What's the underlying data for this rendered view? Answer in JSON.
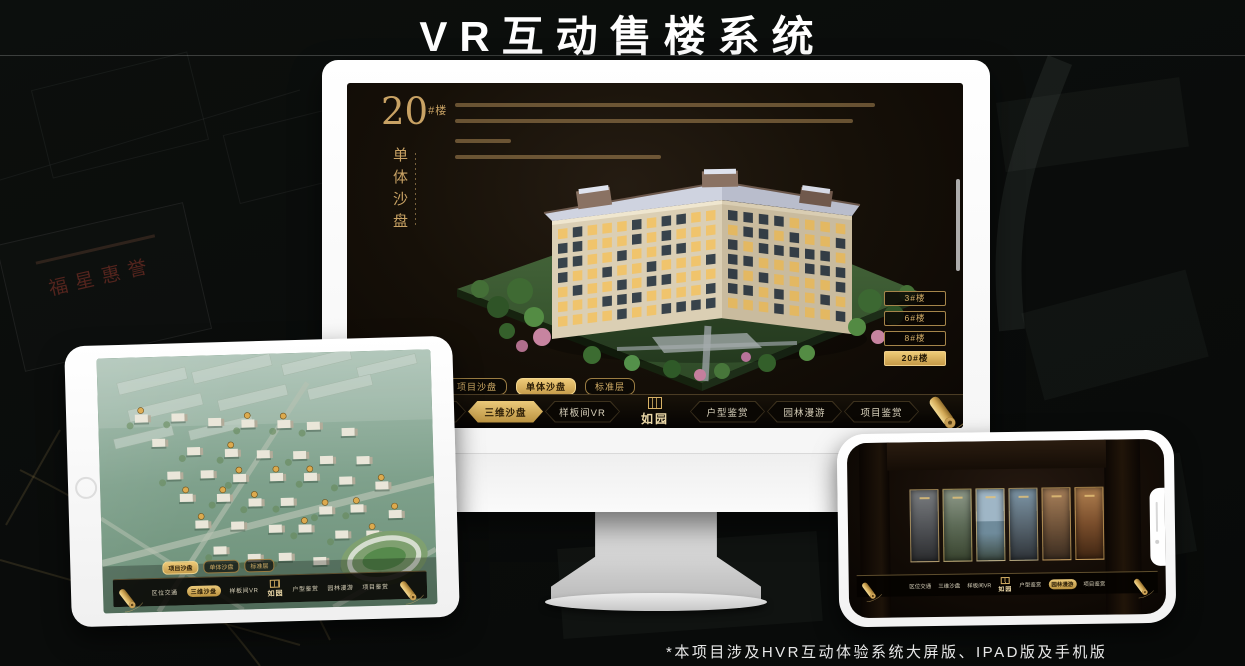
{
  "page": {
    "title": "VR互动售楼系统",
    "footnote": "*本项目涉及HVR互动体验系统大屏版、IPAD版及手机版"
  },
  "background": {
    "plaque_text": "福星惠誉"
  },
  "colors": {
    "gold": "#c79e58",
    "gold_bright": "#ecca7e",
    "active_text": "#2a1c06",
    "screen_bg": "#140e08",
    "device_frame": "#ffffff"
  },
  "monitor": {
    "headline": {
      "number": "20",
      "suffix": "#楼",
      "subtitle": "单体沙盘"
    },
    "floor_buttons": [
      {
        "label": "3#楼",
        "active": false
      },
      {
        "label": "6#楼",
        "active": false
      },
      {
        "label": "8#楼",
        "active": false
      },
      {
        "label": "20#楼",
        "active": true
      }
    ],
    "view_tabs": [
      {
        "label": "项目沙盘",
        "active": false
      },
      {
        "label": "单体沙盘",
        "active": true
      },
      {
        "label": "标准层",
        "active": false
      }
    ],
    "nav": {
      "items": [
        {
          "label": "区位交通",
          "active": false
        },
        {
          "label": "三维沙盘",
          "active": true
        },
        {
          "label": "样板间VR",
          "active": false
        },
        {
          "label": "户型鉴赏",
          "active": false
        },
        {
          "label": "园林漫游",
          "active": false
        },
        {
          "label": "项目鉴赏",
          "active": false
        }
      ],
      "logo": "如园"
    }
  },
  "ipad": {
    "view_tabs": [
      {
        "label": "项目沙盘",
        "active": true
      },
      {
        "label": "单体沙盘",
        "active": false
      },
      {
        "label": "标准层",
        "active": false
      }
    ],
    "nav": {
      "items": [
        {
          "label": "区位交通",
          "active": false
        },
        {
          "label": "三维沙盘",
          "active": true
        },
        {
          "label": "样板间VR",
          "active": false
        },
        {
          "label": "户型鉴赏",
          "active": false
        },
        {
          "label": "园林漫游",
          "active": false
        },
        {
          "label": "项目鉴赏",
          "active": false
        }
      ],
      "logo": "如园"
    }
  },
  "phone": {
    "nav": {
      "items": [
        {
          "label": "区位交通",
          "active": false
        },
        {
          "label": "三维沙盘",
          "active": false
        },
        {
          "label": "样板间VR",
          "active": false
        },
        {
          "label": "户型鉴赏",
          "active": false
        },
        {
          "label": "园林漫游",
          "active": true
        },
        {
          "label": "项目鉴赏",
          "active": false
        }
      ],
      "logo": "如园"
    }
  }
}
